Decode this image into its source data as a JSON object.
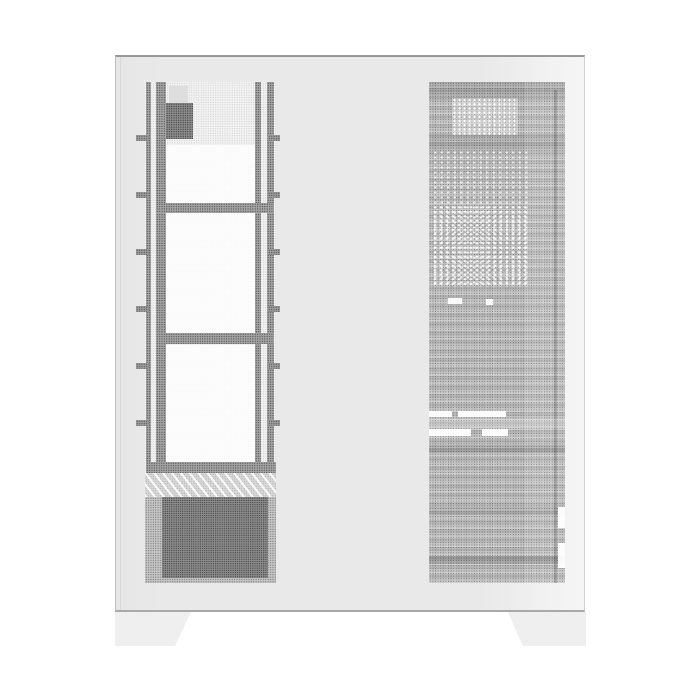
{
  "scene": {
    "description": "Product photograph of a white mid-tower PC computer case, flat side view on a plain white background. The side shows two perforated mesh strips: a fine light mesh on the left revealing an internal fan/radiator mounting bracket and PSU, and a denser darker mesh on the right revealing internal components and drive-bay slots. Two trapezoidal feet support the case."
  },
  "colors": {
    "background": "#ffffff",
    "case-body": "#e9e9e9",
    "case-edge-top": "#969696",
    "case-edge-bottom": "#a9a9a9",
    "foot": "#efefef",
    "mesh-light-bg": "#f1f1f1",
    "mesh-light-dot": "#c6c6c6",
    "mesh-dark-bg": "#c0c0c0",
    "mesh-dark-dot": "#6e6e6e",
    "bracket": "#a3a3a3",
    "plate": "#fcfcfc",
    "io-block": "#8a8a8a",
    "psu": "#8a8a8a",
    "vent": "#d8d8d8"
  },
  "parts": {
    "case": "white steel chassis",
    "left_vent": "fine perforated side vent",
    "right_vent": "dense perforated rear-side panel",
    "bracket": "internal fan/radiator bracket with three mounting plates",
    "psu": "power supply unit behind bottom shroud vent",
    "drive_slots": "white drive-bay slot cutouts visible through mesh",
    "feet": "two trapezoid case feet"
  }
}
